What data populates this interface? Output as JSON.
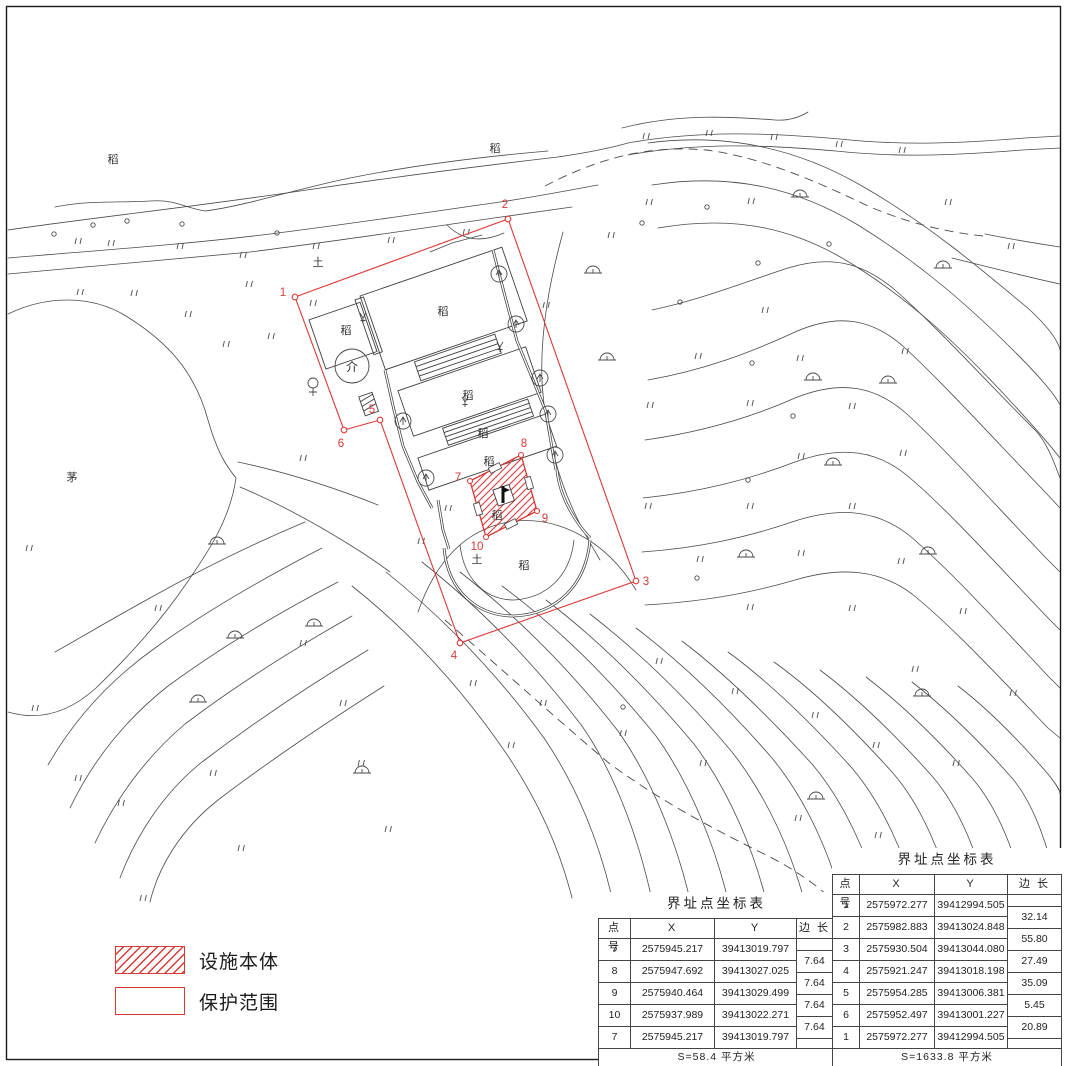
{
  "map": {
    "labels": {
      "paddy": "稻",
      "soil": "土",
      "thatch": "茅",
      "conifer": "介"
    },
    "point_labels": [
      "1",
      "2",
      "3",
      "4",
      "5",
      "6",
      "7",
      "8",
      "9",
      "10"
    ]
  },
  "legend": {
    "facility_label": "设施本体",
    "protection_label": "保护范围"
  },
  "tables": {
    "outer": {
      "title": "界址点坐标表",
      "headers": [
        "点 号",
        "X",
        "Y",
        "边 长"
      ],
      "rows": [
        {
          "id": "1",
          "x": "2575972.277",
          "y": "39412994.505"
        },
        {
          "id": "2",
          "x": "2575982.883",
          "y": "39413024.848"
        },
        {
          "id": "3",
          "x": "2575930.504",
          "y": "39413044.080"
        },
        {
          "id": "4",
          "x": "2575921.247",
          "y": "39413018.198"
        },
        {
          "id": "5",
          "x": "2575954.285",
          "y": "39413006.381"
        },
        {
          "id": "6",
          "x": "2575952.497",
          "y": "39413001.227"
        },
        {
          "id": "1",
          "x": "2575972.277",
          "y": "39412994.505"
        }
      ],
      "lengths": [
        "32.14",
        "55.80",
        "27.49",
        "35.09",
        "5.45",
        "20.89"
      ],
      "area": "S=1633.8 平方米"
    },
    "inner": {
      "title": "界址点坐标表",
      "headers": [
        "点 号",
        "X",
        "Y",
        "边 长"
      ],
      "rows": [
        {
          "id": "7",
          "x": "2575945.217",
          "y": "39413019.797"
        },
        {
          "id": "8",
          "x": "2575947.692",
          "y": "39413027.025"
        },
        {
          "id": "9",
          "x": "2575940.464",
          "y": "39413029.499"
        },
        {
          "id": "10",
          "x": "2575937.989",
          "y": "39413022.271"
        },
        {
          "id": "7",
          "x": "2575945.217",
          "y": "39413019.797"
        }
      ],
      "lengths": [
        "7.64",
        "7.64",
        "7.64",
        "7.64"
      ],
      "area": "S=58.4 平方米"
    }
  },
  "colors": {
    "boundary_red": "#d93a36",
    "ink": "#444444"
  }
}
